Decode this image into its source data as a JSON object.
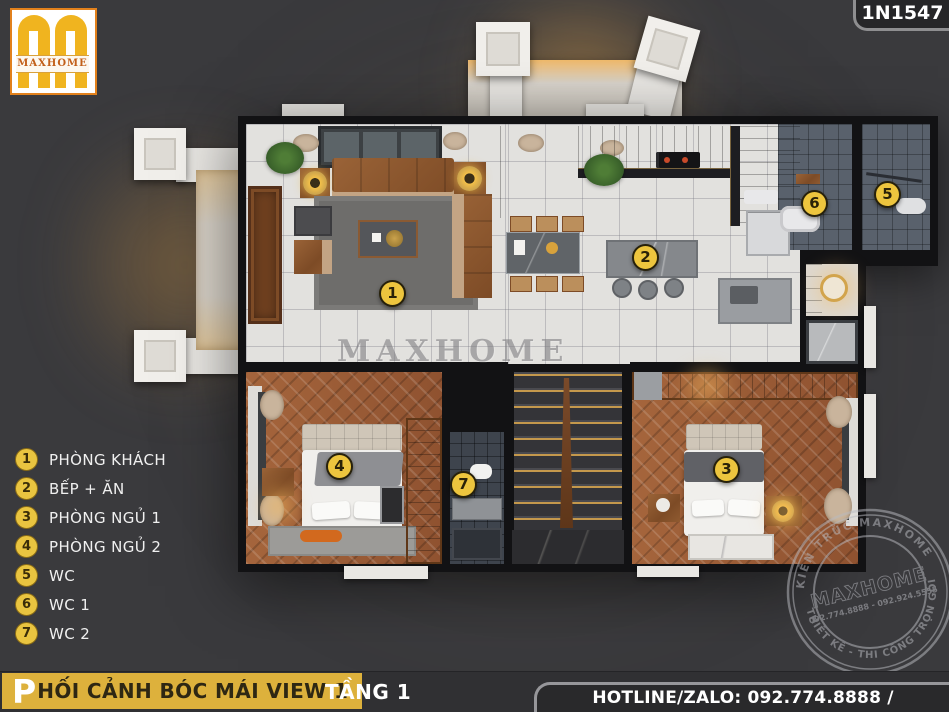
{
  "brand": {
    "logo_text": "MAXHOME",
    "project_code": "1N1547"
  },
  "legend": {
    "items": [
      {
        "num": "1",
        "label": "PHÒNG KHÁCH"
      },
      {
        "num": "2",
        "label": "BẾP + ĂN"
      },
      {
        "num": "3",
        "label": "PHÒNG NGỦ 1"
      },
      {
        "num": "4",
        "label": "PHÒNG NGỦ 2"
      },
      {
        "num": "5",
        "label": "WC"
      },
      {
        "num": "6",
        "label": "WC 1"
      },
      {
        "num": "7",
        "label": "WC 2"
      }
    ]
  },
  "plan": {
    "watermark": "MAXHOME"
  },
  "stamp": {
    "arc_top": "KIẾN TRÚC MAXHOME",
    "arc_bottom": "THIẾT KẾ - THI CÔNG TRỌN GÓI",
    "center": "MAXHOME",
    "phone_line": "092.774.8888 - 092.924.5555"
  },
  "footer": {
    "title_initial": "P",
    "title_rest": "HỐI CẢNH BÓC MÁI VIEW 1",
    "floor_label": "TẦNG 1",
    "hotline": "HOTLINE/ZALO: 092.774.8888 / 092.924.5555"
  },
  "colors": {
    "accent_yellow": "#ddb13c",
    "marker_yellow": "#edc53e",
    "background": "#3a3a3d"
  }
}
